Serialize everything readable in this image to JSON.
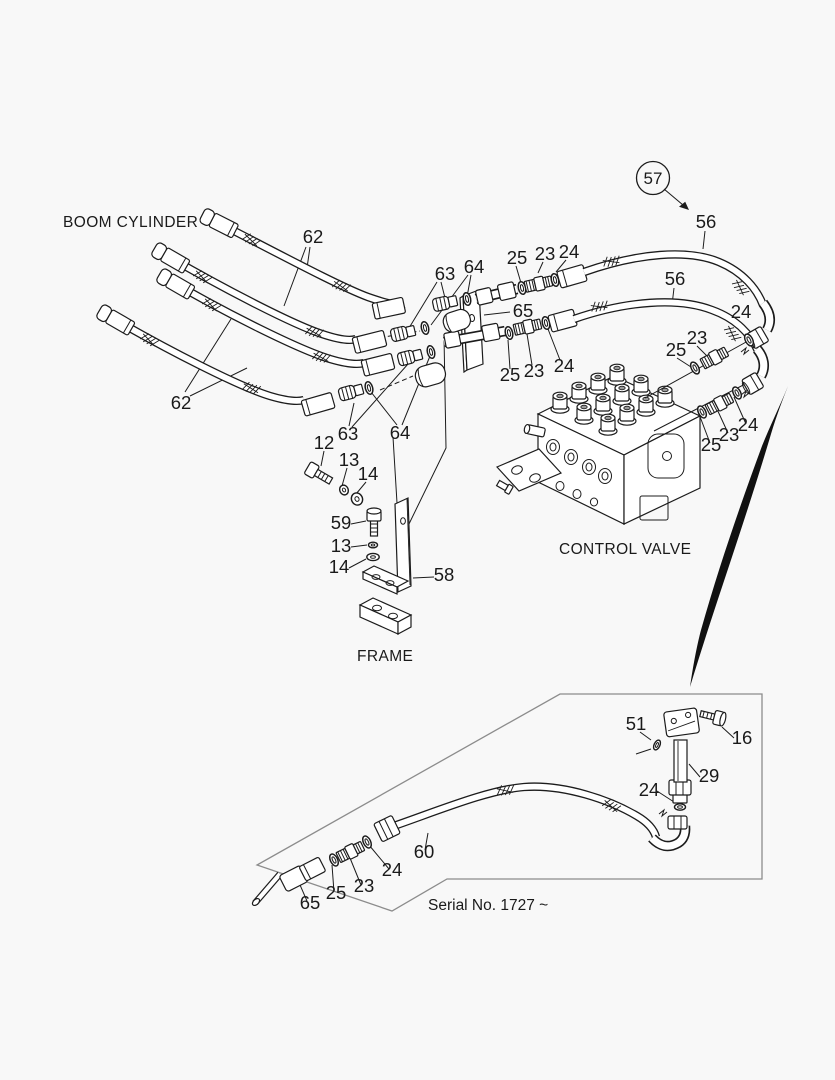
{
  "page": {
    "background": "#f8f8f8",
    "ink": "#1c1c1c",
    "box_border": "#8c8c8c"
  },
  "diagram": {
    "section_labels": {
      "boom_cylinder": "BOOM CYLINDER",
      "control_valve": "CONTROL VALVE",
      "frame": "FRAME"
    },
    "serial_note": "Serial No. 1727 ~",
    "balloon": {
      "text": "57"
    },
    "callouts": [
      {
        "t": "62",
        "x": 313,
        "y": 243
      },
      {
        "t": "63",
        "x": 445,
        "y": 280
      },
      {
        "t": "64",
        "x": 474,
        "y": 273
      },
      {
        "t": "25",
        "x": 517,
        "y": 264
      },
      {
        "t": "23",
        "x": 545,
        "y": 260
      },
      {
        "t": "24",
        "x": 569,
        "y": 258
      },
      {
        "t": "56",
        "x": 706,
        "y": 228
      },
      {
        "t": "56",
        "x": 675,
        "y": 285
      },
      {
        "t": "65",
        "x": 523,
        "y": 317
      },
      {
        "t": "25",
        "x": 510,
        "y": 381
      },
      {
        "t": "23",
        "x": 534,
        "y": 377
      },
      {
        "t": "24",
        "x": 564,
        "y": 372
      },
      {
        "t": "24",
        "x": 741,
        "y": 318
      },
      {
        "t": "23",
        "x": 697,
        "y": 344
      },
      {
        "t": "25",
        "x": 676,
        "y": 356
      },
      {
        "t": "62",
        "x": 181,
        "y": 409
      },
      {
        "t": "63",
        "x": 348,
        "y": 440
      },
      {
        "t": "64",
        "x": 400,
        "y": 439
      },
      {
        "t": "12",
        "x": 324,
        "y": 449
      },
      {
        "t": "13",
        "x": 349,
        "y": 466
      },
      {
        "t": "14",
        "x": 368,
        "y": 480
      },
      {
        "t": "59",
        "x": 341,
        "y": 529
      },
      {
        "t": "13",
        "x": 341,
        "y": 552
      },
      {
        "t": "14",
        "x": 339,
        "y": 573
      },
      {
        "t": "58",
        "x": 444,
        "y": 581
      },
      {
        "t": "25",
        "x": 711,
        "y": 451
      },
      {
        "t": "23",
        "x": 729,
        "y": 441
      },
      {
        "t": "24",
        "x": 748,
        "y": 431
      },
      {
        "t": "51",
        "x": 636,
        "y": 730
      },
      {
        "t": "16",
        "x": 742,
        "y": 744
      },
      {
        "t": "29",
        "x": 709,
        "y": 782
      },
      {
        "t": "24",
        "x": 649,
        "y": 796
      },
      {
        "t": "60",
        "x": 424,
        "y": 858
      },
      {
        "t": "24",
        "x": 392,
        "y": 876
      },
      {
        "t": "23",
        "x": 364,
        "y": 892
      },
      {
        "t": "25",
        "x": 336,
        "y": 899
      },
      {
        "t": "65",
        "x": 310,
        "y": 909
      }
    ]
  }
}
